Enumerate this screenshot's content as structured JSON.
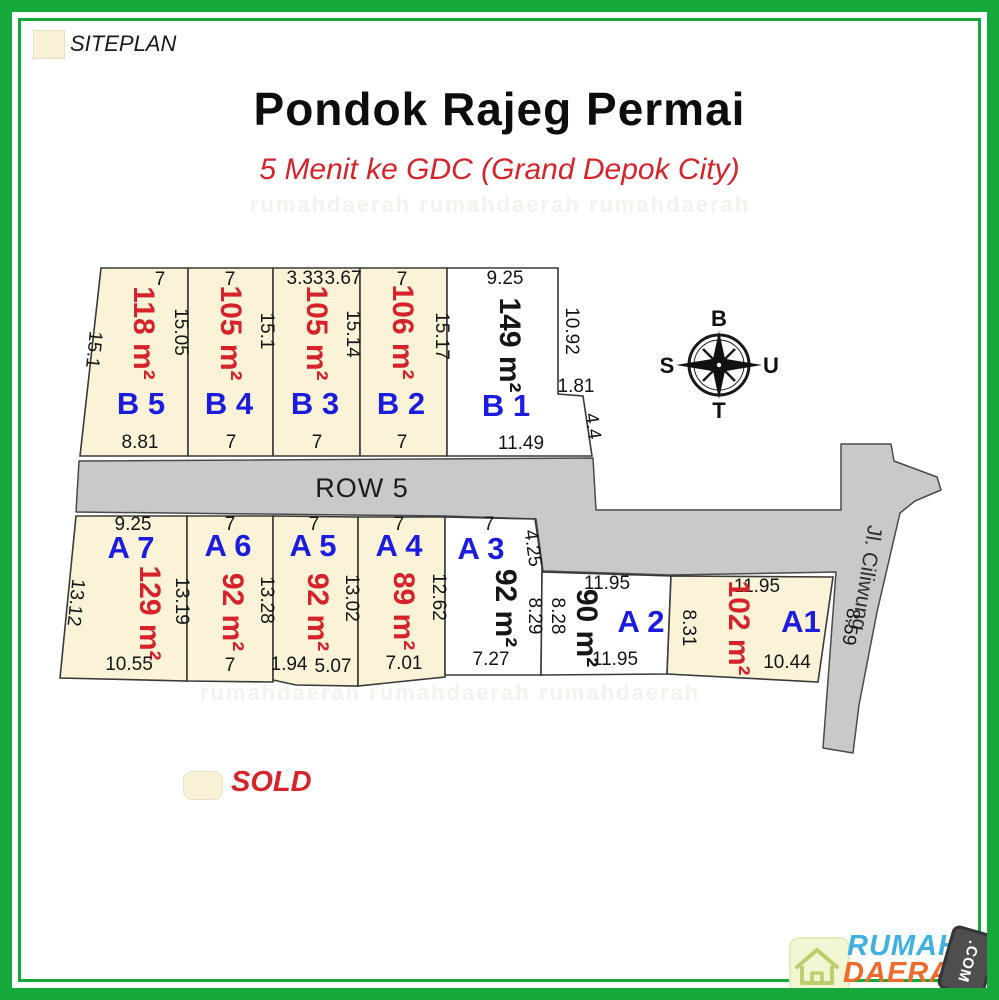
{
  "header": {
    "siteplan_label": "SITEPLAN",
    "title": "Pondok Rajeg Permai",
    "subtitle": "5 Menit ke GDC (Grand Depok City)"
  },
  "legend": {
    "sold_label": "SOLD"
  },
  "roads": {
    "row5_label": "ROW 5",
    "street_label": "Jl. Ciliwung"
  },
  "compass": {
    "top": "B",
    "right": "U",
    "bottom": "T",
    "left": "S"
  },
  "watermark": {
    "row": "rumahdaerah   rumahdaerah   rumahdaerah"
  },
  "logo": {
    "word1": "RUMAH",
    "word2": "DAERAH",
    "badge": ".COM"
  },
  "colors": {
    "frame_green": "#17a83c",
    "sold_fill": "#faf3d8",
    "available_fill": "#ffffff",
    "road_fill": "#c9c9c9",
    "area_red": "#d6232b",
    "plot_id_blue": "#1c1cdf"
  },
  "plots": {
    "b5": {
      "id": "B 5",
      "area": "118 m²",
      "dim_top": "7",
      "dim_left": "15.1",
      "dim_right": "15.05",
      "dim_bottom": "8.81",
      "status": "sold"
    },
    "b4": {
      "id": "B 4",
      "area": "105 m²",
      "dim_top": "7",
      "dim_right": "15.1",
      "dim_bottom": "7",
      "status": "sold"
    },
    "b3": {
      "id": "B 3",
      "area": "105 m²",
      "dim_top_left": "3.33",
      "dim_top_right": "3.67",
      "dim_right": "15.14",
      "dim_bottom": "7",
      "status": "sold"
    },
    "b2": {
      "id": "B 2",
      "area": "106 m²",
      "dim_top": "7",
      "dim_right": "15.17",
      "dim_bottom": "7",
      "status": "sold"
    },
    "b1": {
      "id": "B 1",
      "area": "149 m²",
      "dim_top": "9.25",
      "dim_right": "10.92",
      "dim_notch": "1.81",
      "dim_notch_side": "4.4",
      "dim_bottom": "11.49",
      "status": "available"
    },
    "a7": {
      "id": "A 7",
      "area": "129 m²",
      "dim_top": "9.25",
      "dim_left": "13.12",
      "dim_right": "13.19",
      "dim_bottom": "10.55",
      "status": "sold"
    },
    "a6": {
      "id": "A 6",
      "area": "92 m²",
      "dim_top": "7",
      "dim_right": "13.28",
      "dim_bottom": "7",
      "status": "sold"
    },
    "a5": {
      "id": "A 5",
      "area": "92 m²",
      "dim_top": "7",
      "dim_right": "13.02",
      "dim_bottom_left": "1.94",
      "dim_bottom_right": "5.07",
      "status": "sold"
    },
    "a4": {
      "id": "A 4",
      "area": "89 m²",
      "dim_top": "7",
      "dim_right": "12.62",
      "dim_bottom": "7.01",
      "status": "sold"
    },
    "a3": {
      "id": "A 3",
      "area": "92 m²",
      "dim_top": "7",
      "dim_top_right": "4.25",
      "dim_right": "8.29",
      "dim_bottom": "7.27",
      "status": "available"
    },
    "a2": {
      "id": "A 2",
      "area": "90 m²",
      "dim_top": "11.95",
      "dim_left": "8.28",
      "dim_bottom": "11.95",
      "status": "available"
    },
    "a1": {
      "id": "A1",
      "area": "102 m²",
      "dim_top": "11.95",
      "dim_left": "8.31",
      "dim_right": "8.59",
      "dim_bottom": "10.44",
      "status": "sold"
    }
  }
}
